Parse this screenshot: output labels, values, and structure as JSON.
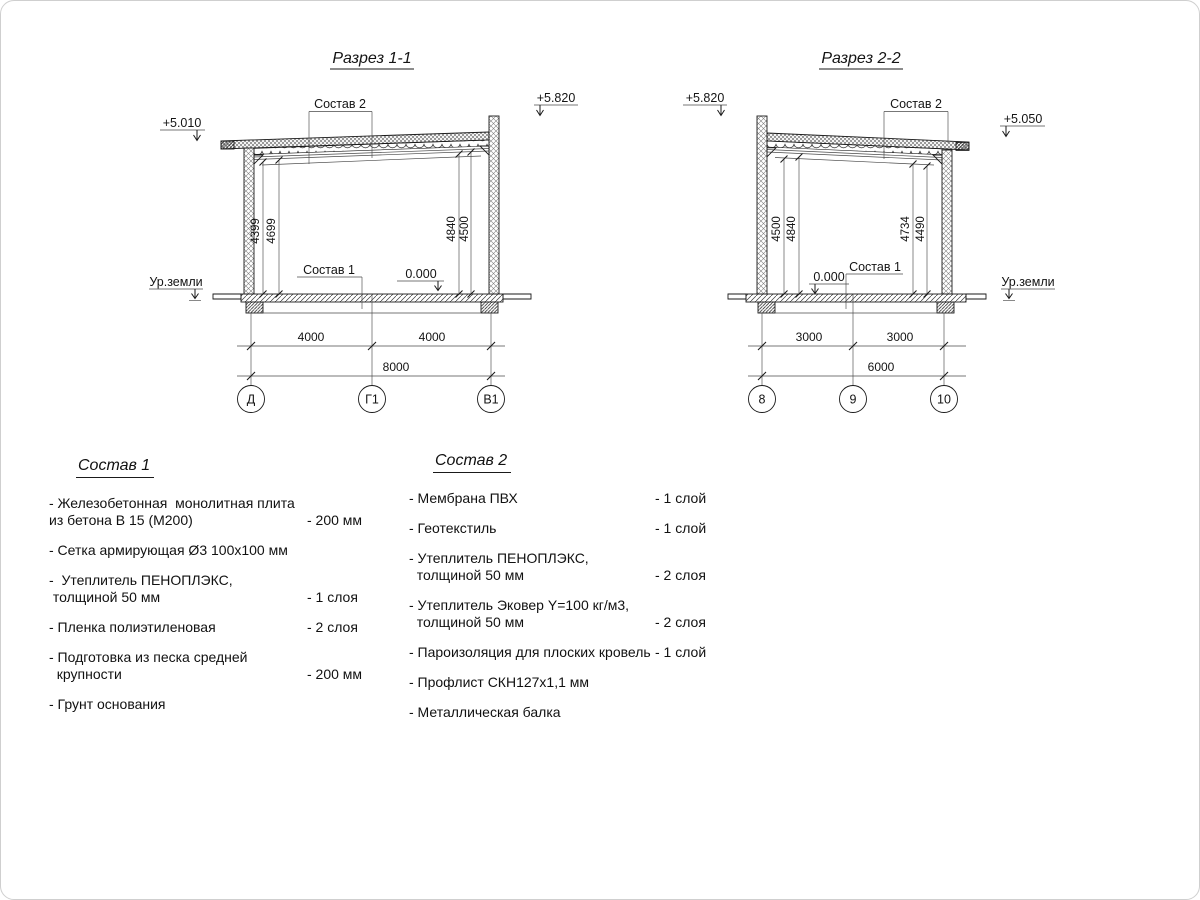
{
  "section1": {
    "title": "Разрез 1-1",
    "elev_left": "+5.010",
    "elev_right": "+5.820",
    "roof_composition_label": "Состав 2",
    "floor_composition_label": "Состав 1",
    "zero_level": "0.000",
    "ground_label": "Ур.земли",
    "height_dims_left": [
      "4399",
      "4699"
    ],
    "height_dims_right": [
      "4840",
      "4500"
    ],
    "span_dims": [
      "4000",
      "4000"
    ],
    "total_span": "8000",
    "axes": [
      "Д",
      "Г1",
      "В1"
    ]
  },
  "section2": {
    "title": "Разрез 2-2",
    "elev_left": "+5.820",
    "elev_right": "+5.050",
    "roof_composition_label": "Состав 2",
    "floor_composition_label": "Состав 1",
    "zero_level": "0.000",
    "ground_label": "Ур.земли",
    "height_dims_left": [
      "4500",
      "4840"
    ],
    "height_dims_right": [
      "4734",
      "4490"
    ],
    "span_dims": [
      "3000",
      "3000"
    ],
    "total_span": "6000",
    "axes": [
      "8",
      "9",
      "10"
    ]
  },
  "composition1": {
    "title": "Состав 1",
    "items": [
      {
        "name": "- Железобетонная  монолитная плита\nиз бетона В 15 (М200)",
        "value": "- 200 мм"
      },
      {
        "name": "- Сетка армирующая Ø3 100х100 мм",
        "value": ""
      },
      {
        "name": "-  Утеплитель ПЕНОПЛЭКС,\n толщиной 50 мм",
        "value": "- 1 слоя"
      },
      {
        "name": "- Пленка полиэтиленовая",
        "value": "-  2 слоя"
      },
      {
        "name": "- Подготовка из песка средней\n  крупности",
        "value": "- 200 мм"
      },
      {
        "name": "- Грунт основания",
        "value": ""
      }
    ]
  },
  "composition2": {
    "title": "Состав 2",
    "items": [
      {
        "name": "- Мембрана ПВХ",
        "value": "- 1 слой"
      },
      {
        "name": "- Геотекстиль",
        "value": "- 1 слой"
      },
      {
        "name": "- Утеплитель ПЕНОПЛЭКС,\n  толщиной 50 мм",
        "value": "- 2 слоя"
      },
      {
        "name": "- Утеплитель Эковер Y=100 кг/м3,\n  толщиной 50 мм",
        "value": "- 2 слоя"
      },
      {
        "name": "- Пароизоляция для плоских кровель",
        "value": "- 1 слой"
      },
      {
        "name": "- Профлист СКН127х1,1 мм",
        "value": ""
      },
      {
        "name": "- Металлическая балка",
        "value": ""
      }
    ]
  }
}
